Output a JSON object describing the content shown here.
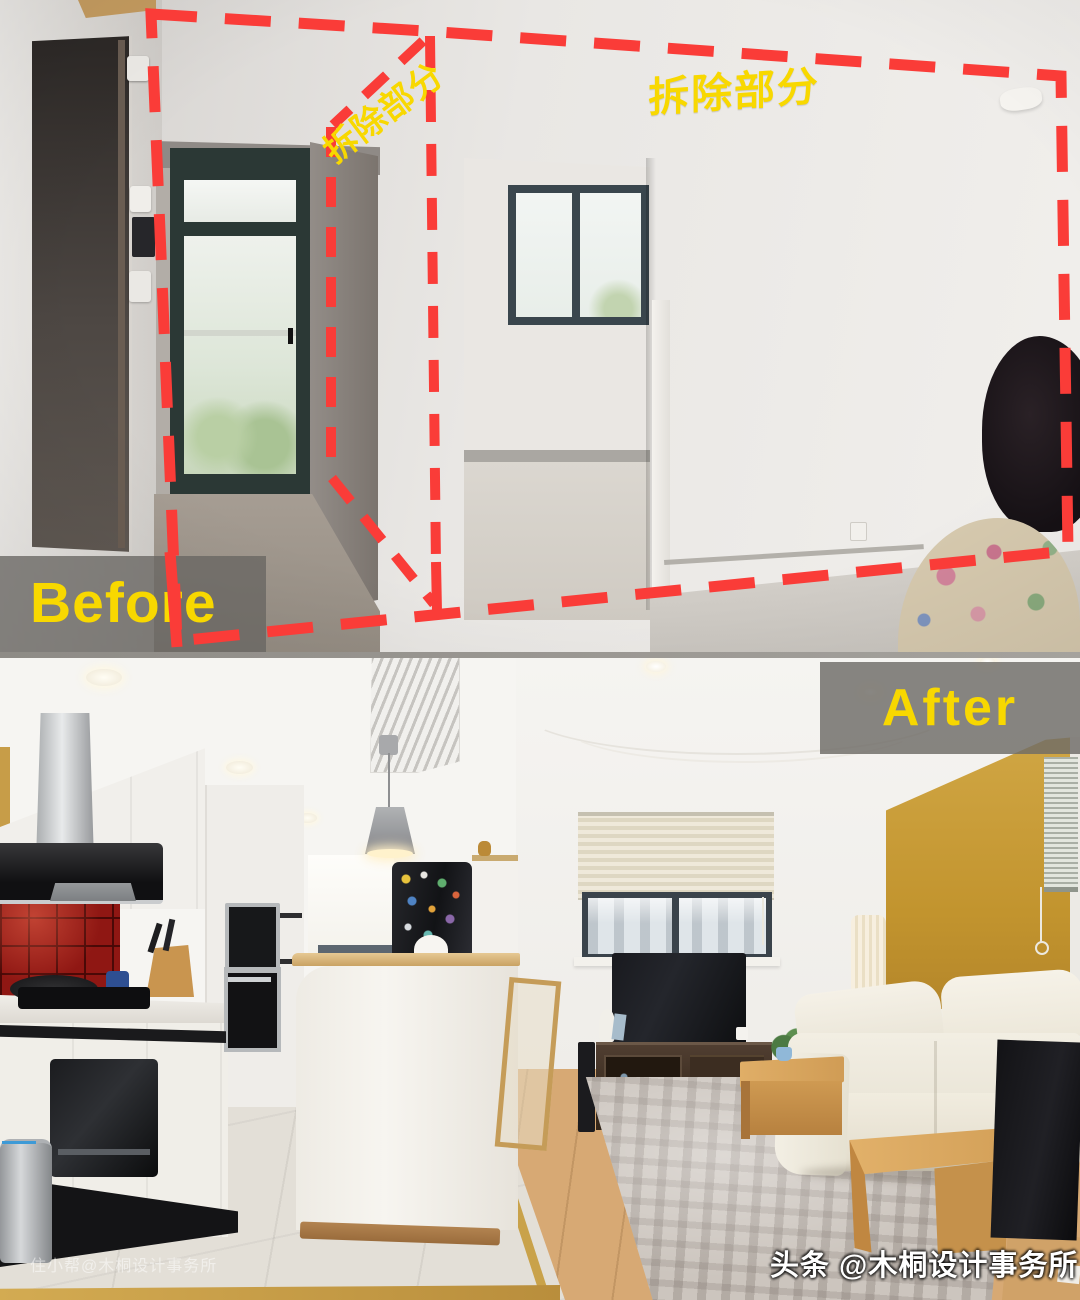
{
  "image": {
    "title": "Before / After apartment renovation comparison photo",
    "width_px": 1080,
    "height_px": 1300
  },
  "colors": {
    "annotation_red": "#fa3c38",
    "annotation_yellow": "#f8d800",
    "label_box_gray": "#6b6863",
    "accent_wall_yellow": "#c79a35"
  },
  "before": {
    "label": "Before",
    "demolition_label_left": "拆除部分",
    "demolition_label_right": "拆除部分"
  },
  "after": {
    "label": "After"
  },
  "watermarks": {
    "bottom_left": "住小帮@木桐设计事务所",
    "bottom_right": "头条 @木桐设计事务所"
  }
}
